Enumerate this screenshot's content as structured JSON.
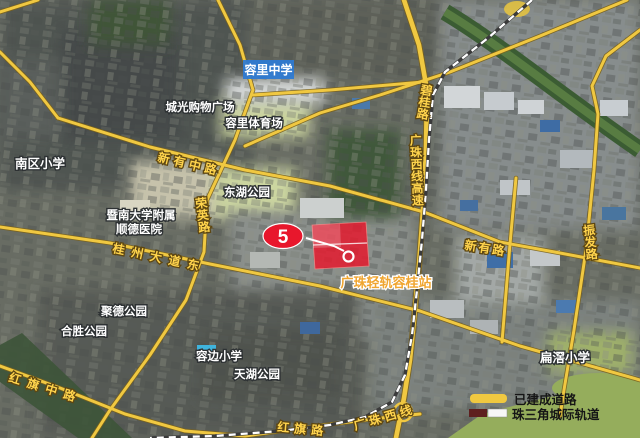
{
  "map": {
    "marker_number": "5",
    "station_label": "广珠轻轨容桂站",
    "highlight_box_label": "容里中学",
    "place_labels": [
      "城光购物广场",
      "容里体育场",
      "南区小学",
      "东湖公园",
      "暨南大学附属",
      "顺德医院",
      "聚德公园",
      "合胜公园",
      "容边小学",
      "天湖公园",
      "扁滘小学"
    ],
    "road_labels": [
      "新有中路",
      "桂州大道东",
      "红旗中路",
      "红旗路",
      "新有路",
      "广珠西线",
      "荣英路",
      "碧桂路",
      "广珠西线高速",
      "振发路"
    ],
    "legend": {
      "built_road_label": "已建成道路",
      "rail_label": "珠三角城际轨道"
    },
    "colors": {
      "road_yellow": "#f0c841",
      "parcel_red": "#e8172c",
      "school_box_blue": "#2e7ad2",
      "station_label_orange": "#f0a52f",
      "legend_rail_dark": "#5e1f1f"
    }
  }
}
